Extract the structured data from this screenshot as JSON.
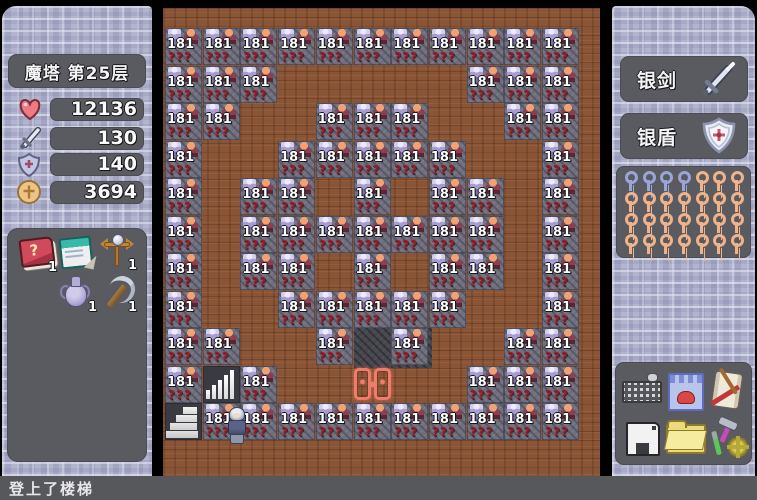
{
  "left_panel": {
    "floor_label": "魔塔 第25层",
    "stats": [
      {
        "name": "hp",
        "icon": "heart-icon",
        "value": "12136"
      },
      {
        "name": "attack",
        "icon": "sword-icon",
        "value": "130"
      },
      {
        "name": "defense",
        "icon": "shield-icon",
        "value": "140"
      },
      {
        "name": "gold",
        "icon": "coin-icon",
        "value": "3694"
      }
    ],
    "items": [
      {
        "name": "monster-manual",
        "icon": "book-icon",
        "glyph": "?",
        "count": "1"
      },
      {
        "name": "auto-map",
        "icon": "notebook-icon",
        "glyph": "",
        "count": ""
      },
      {
        "name": "holy-cross",
        "icon": "cross-staff-icon",
        "glyph": "",
        "count": "1"
      },
      {
        "name": "holy-water-jar",
        "icon": "jar-icon",
        "glyph": "",
        "count": "1"
      },
      {
        "name": "pickaxe",
        "icon": "pickaxe-icon",
        "glyph": "",
        "count": "1"
      }
    ]
  },
  "right_panel": {
    "equipment": [
      {
        "name": "weapon",
        "label": "银剑",
        "icon": "sword-icon"
      },
      {
        "name": "armor",
        "label": "银盾",
        "icon": "shield-icon"
      }
    ],
    "keys": {
      "rows": [
        [
          "blue",
          "blue",
          "blue",
          "blue",
          "orange",
          "orange",
          "orange"
        ],
        [
          "orange",
          "orange",
          "orange",
          "orange",
          "orange",
          "orange",
          "orange"
        ],
        [
          "orange",
          "orange",
          "orange",
          "orange",
          "orange",
          "orange",
          "orange"
        ],
        [
          "orange",
          "orange",
          "orange",
          "orange",
          "orange",
          "orange",
          "orange"
        ]
      ],
      "blue_count": 4,
      "orange_count": 24
    },
    "buttons": [
      {
        "name": "keyboard-button",
        "icon": "keyboard-icon",
        "style": "icon-kbd"
      },
      {
        "name": "shop-button",
        "icon": "shop-icon",
        "style": "icon-shop"
      },
      {
        "name": "scroll-button",
        "icon": "scroll-icon",
        "style": "icon-scroll"
      },
      {
        "name": "save-button",
        "icon": "floppy-icon",
        "style": "icon-floppy"
      },
      {
        "name": "load-button",
        "icon": "folder-icon",
        "style": "icon-folder"
      },
      {
        "name": "tools-button",
        "icon": "tools-icon",
        "style": "icon-tools"
      }
    ]
  },
  "map": {
    "tile_label": "181",
    "tile_sub": "???",
    "monster_rows": [
      {
        "row": 1,
        "cols": [
          0,
          1,
          2,
          3,
          4,
          5,
          6,
          7,
          8,
          9,
          10
        ]
      },
      {
        "row": 2,
        "cols": [
          0,
          1,
          2,
          8,
          9,
          10
        ]
      },
      {
        "row": 3,
        "cols": [
          0,
          1,
          4,
          5,
          6,
          9,
          10
        ]
      },
      {
        "row": 4,
        "cols": [
          0,
          3,
          4,
          5,
          6,
          7,
          10
        ]
      },
      {
        "row": 5,
        "cols": [
          0,
          2,
          3,
          5,
          7,
          8,
          10
        ]
      },
      {
        "row": 6,
        "cols": [
          0,
          2,
          3,
          4,
          5,
          6,
          7,
          8,
          10
        ]
      },
      {
        "row": 7,
        "cols": [
          0,
          2,
          3,
          5,
          7,
          8,
          10
        ]
      },
      {
        "row": 8,
        "cols": [
          0,
          3,
          4,
          5,
          6,
          7,
          10
        ]
      },
      {
        "row": 9,
        "cols": [
          0,
          1,
          4,
          6,
          9,
          10
        ]
      },
      {
        "row": 10,
        "cols": [
          0,
          2,
          8,
          9,
          10
        ]
      },
      {
        "row": 11,
        "cols": [
          1,
          2,
          3,
          4,
          5,
          6,
          7,
          8,
          9,
          10
        ]
      }
    ],
    "special_tiles": [
      {
        "row": 9,
        "col": 5,
        "type": "dark-floor"
      },
      {
        "row": 9,
        "col": 6,
        "type": "dark-floor"
      },
      {
        "row": 10,
        "col": 1,
        "type": "bars-icon"
      },
      {
        "row": 10,
        "col": 5,
        "type": "portal-icon"
      },
      {
        "row": 11,
        "col": 0,
        "type": "stairs-icon"
      }
    ],
    "player": {
      "row": 11,
      "col": 1
    }
  },
  "status_bar": {
    "text": "登上了楼梯"
  }
}
